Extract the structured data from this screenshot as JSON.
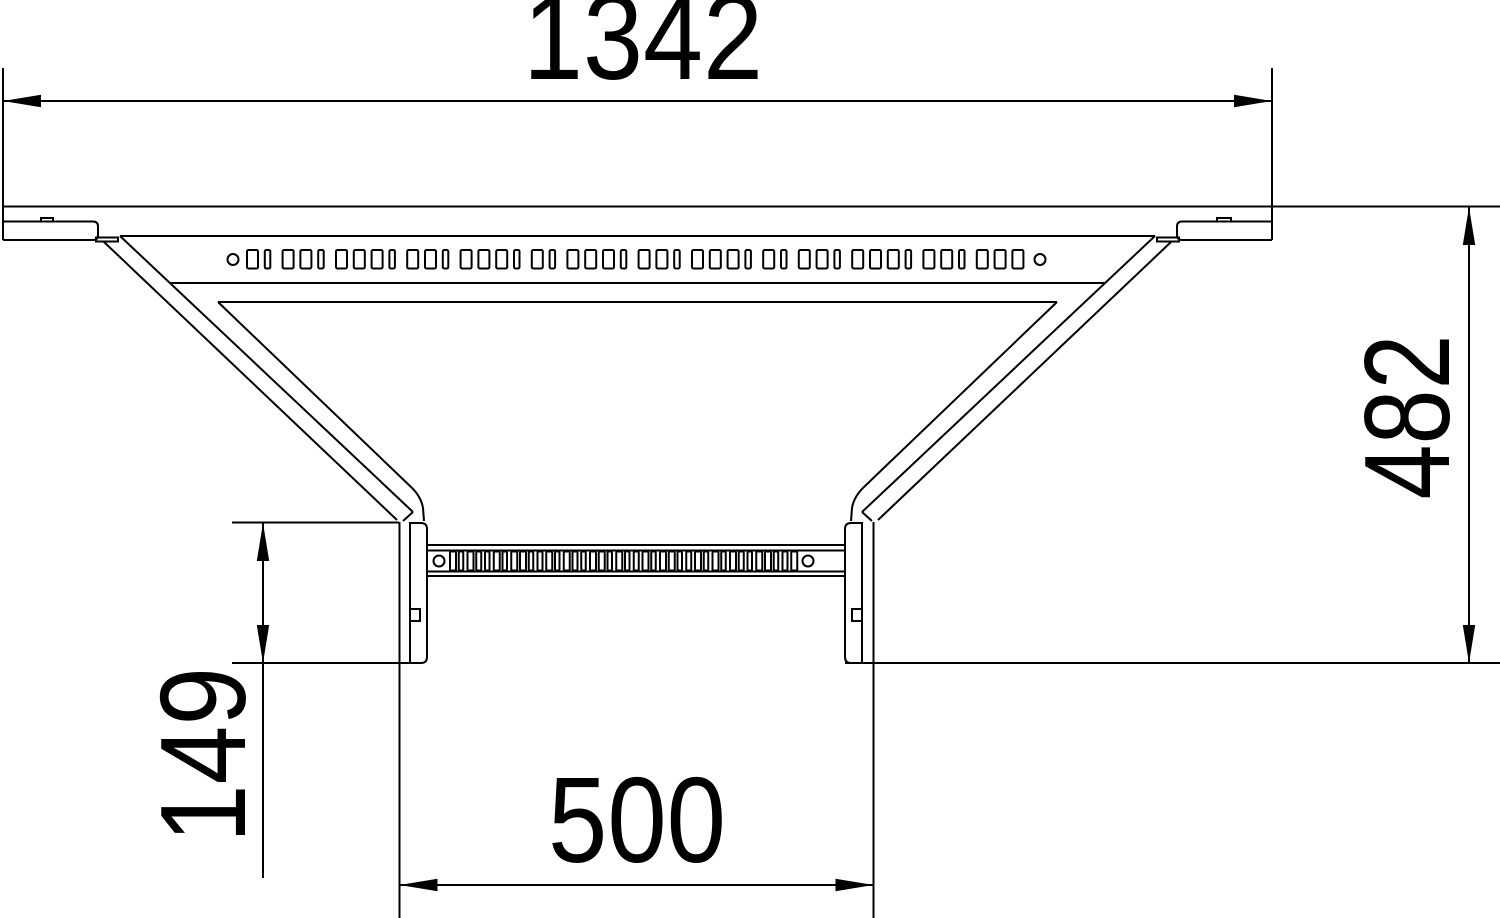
{
  "drawing": {
    "description": "Technical top-view line drawing of a cable tray add-on tee with four linear dimensions",
    "colors": {
      "line": "#000000",
      "background": "#ffffff"
    },
    "dimensions": {
      "overall_width": "1342",
      "overall_depth": "482",
      "branch_offset": "149",
      "branch_width": "500"
    },
    "perforation": {
      "top_row": {
        "y": 250,
        "h": 18.5,
        "start": 247,
        "pitch": 17.8,
        "rx": 1.5,
        "widths": [
          11,
          5.5,
          11,
          11,
          5.5,
          11,
          11,
          11,
          5.5,
          11,
          11,
          5.5,
          11,
          11,
          11,
          5.5,
          11,
          5.5,
          11,
          11,
          11,
          5.5,
          11,
          11,
          5.5,
          11,
          11,
          11,
          5.5,
          11,
          5.5,
          11,
          11,
          5.5,
          11,
          11,
          11,
          5.5,
          11,
          11,
          5.5,
          11,
          11,
          11
        ],
        "circles": [
          {
            "cx": 233,
            "cy": 259.5,
            "r": 5.5
          },
          {
            "cx": 1040,
            "cy": 259.5,
            "r": 5.5
          }
        ]
      },
      "branch_row": {
        "y": 551.5,
        "h": 19,
        "start": 450,
        "pitch": 8.75,
        "rx": 1,
        "widths": [
          6,
          4.5,
          6,
          5,
          4.5,
          6,
          4.5,
          6,
          6,
          4.5,
          5,
          6,
          4.5,
          6,
          5,
          4.5,
          6,
          6,
          4.5,
          6,
          4.5,
          5,
          6,
          4.5,
          6,
          6,
          4.5,
          5,
          6,
          4.5,
          6,
          4.5,
          6,
          5,
          4.5,
          6,
          6,
          4.5,
          5,
          6
        ],
        "circles": [
          {
            "cx": 439,
            "cy": 561,
            "r": 5.5
          },
          {
            "cx": 808,
            "cy": 561,
            "r": 5.5
          }
        ]
      }
    }
  }
}
